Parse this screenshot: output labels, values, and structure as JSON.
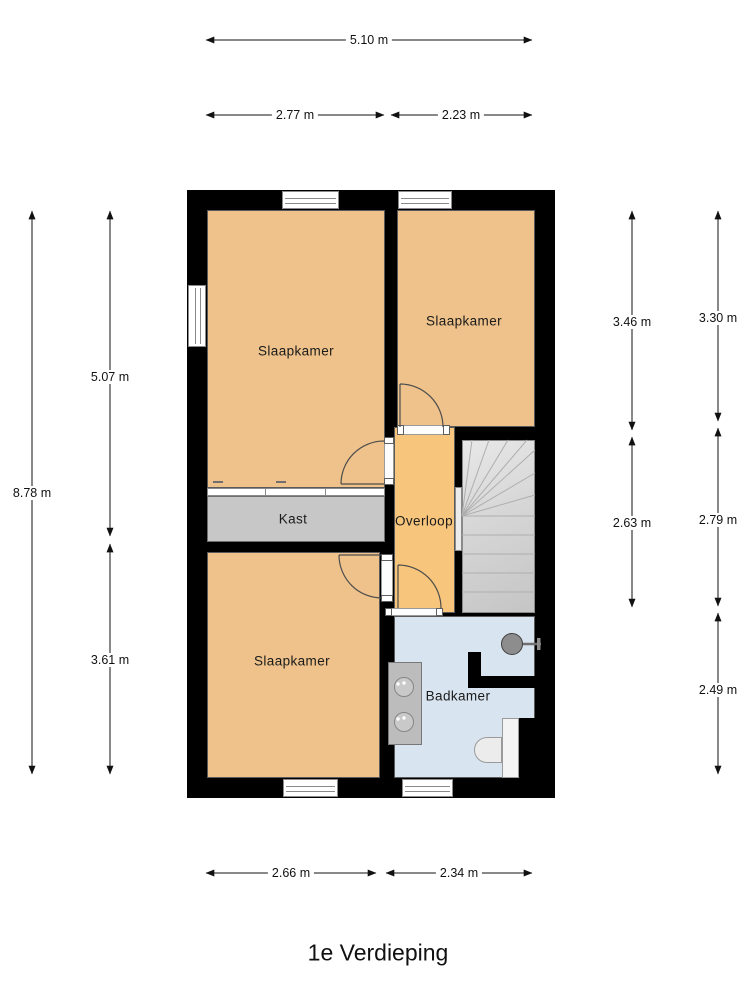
{
  "title": "1e Verdieping",
  "rooms": {
    "bedroom1": {
      "label": "Slaapkamer"
    },
    "bedroom2": {
      "label": "Slaapkamer"
    },
    "bedroom3": {
      "label": "Slaapkamer"
    },
    "closet": {
      "label": "Kast"
    },
    "landing": {
      "label": "Overloop"
    },
    "bathroom": {
      "label": "Badkamer"
    }
  },
  "dimensions": {
    "top_total": "5.10 m",
    "top_left": "2.77 m",
    "top_right": "2.23 m",
    "left_total": "8.78 m",
    "left_upper": "5.07 m",
    "left_lower": "3.61 m",
    "right_inner_upper": "3.46 m",
    "right_inner_lower": "2.63 m",
    "right_outer_upper": "3.30 m",
    "right_outer_middle": "2.79 m",
    "right_outer_lower": "2.49 m",
    "bottom_left": "2.66 m",
    "bottom_right": "2.34 m"
  },
  "fixtures": {
    "staircase": "winder-staircase",
    "bathroom_items": [
      "double-sink-vanity",
      "shower-head",
      "toilet"
    ],
    "closet_door": "sliding-door",
    "hinged_doors": 4,
    "windows": 5
  },
  "colors": {
    "wall": "#000000",
    "bedroom_floor": "#eec28a",
    "landing_floor": "#f8c57c",
    "closet_floor": "#c7c7c7",
    "bathroom_floor": "#d8e4ef",
    "stairs": "#d6d6d6",
    "dimension_text": "#111111"
  }
}
